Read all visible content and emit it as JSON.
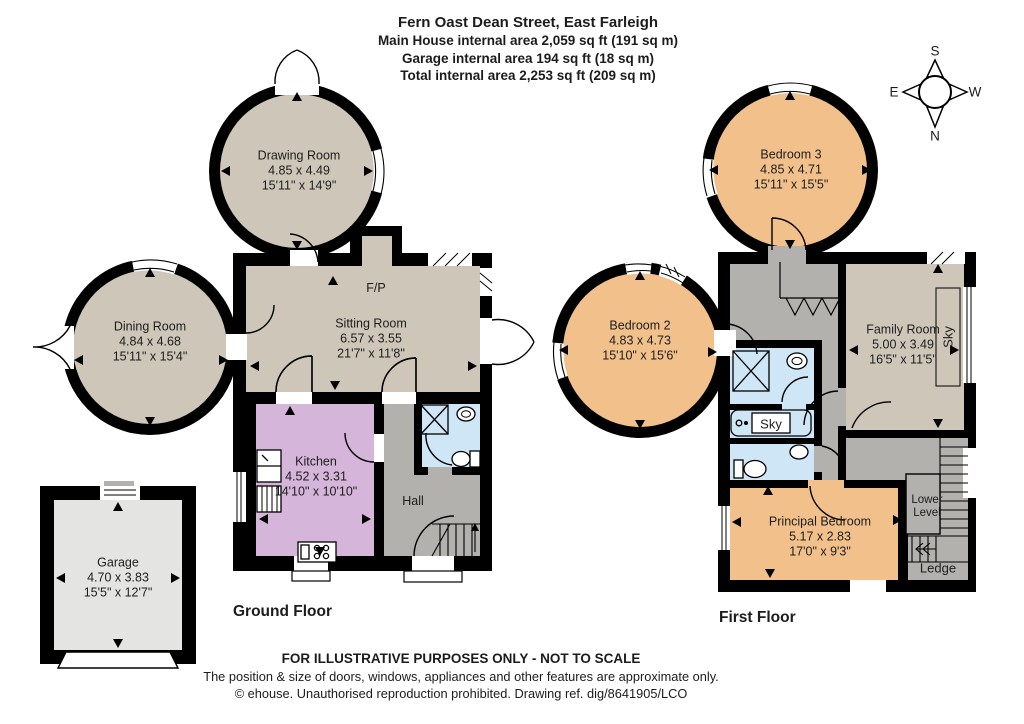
{
  "header": {
    "title": "Fern Oast Dean Street, East Farleigh",
    "area_lines": [
      "Main House internal area 2,059 sq ft (191 sq m)",
      "Garage internal area 194 sq ft (18 sq m)",
      "Total internal area 2,253 sq ft (209 sq m)"
    ]
  },
  "compass": {
    "north": "N",
    "south": "S",
    "east": "E",
    "west": "W"
  },
  "ground_floor": {
    "label": "Ground Floor",
    "fireplace_label": "F/P",
    "rooms": [
      {
        "name": "Drawing Room",
        "metric": "4.85 x 4.49",
        "imperial": "15'11\" x 14'9\""
      },
      {
        "name": "Dining Room",
        "metric": "4.84 x 4.68",
        "imperial": "15'11\" x 15'4\""
      },
      {
        "name": "Sitting Room",
        "metric": "6.57 x 3.55",
        "imperial": "21'7\" x 11'8\""
      },
      {
        "name": "Kitchen",
        "metric": "4.52 x 3.31",
        "imperial": "14'10\" x 10'10\""
      },
      {
        "name": "Hall"
      },
      {
        "name": "Garage",
        "metric": "4.70 x 3.83",
        "imperial": "15'5\" x 12'7\""
      }
    ]
  },
  "first_floor": {
    "label": "First Floor",
    "skylight_label": "Sky",
    "bath_skylight_label": "Sky",
    "lower_level_label": "Lower Level",
    "ledge_label": "Ledge",
    "rooms": [
      {
        "name": "Bedroom 3",
        "metric": "4.85 x 4.71",
        "imperial": "15'11\" x 15'5\""
      },
      {
        "name": "Bedroom 2",
        "metric": "4.83 x 4.73",
        "imperial": "15'10\" x 15'6\""
      },
      {
        "name": "Family Room",
        "metric": "5.00 x 3.49",
        "imperial": "16'5\" x 11'5\""
      },
      {
        "name": "Principal Bedroom",
        "metric": "5.17 x 2.83",
        "imperial": "17'0\" x 9'3\""
      }
    ]
  },
  "footer": {
    "line1": "FOR ILLUSTRATIVE PURPOSES ONLY - NOT TO SCALE",
    "line2": "The position & size of doors, windows, appliances and other features are approximate only.",
    "line3": "© ehouse. Unauthorised reproduction prohibited. Drawing ref. dig/8641905/LCO"
  },
  "colors": {
    "wall": "#000000",
    "reception_beige": "#cec6b9",
    "bedroom_orange": "#f2c18b",
    "kitchen_purple": "#d5b5d9",
    "hall_gray": "#b3b1ae",
    "bathroom_blue": "#cfe6f7",
    "garage_gray": "#e4e4e2"
  }
}
